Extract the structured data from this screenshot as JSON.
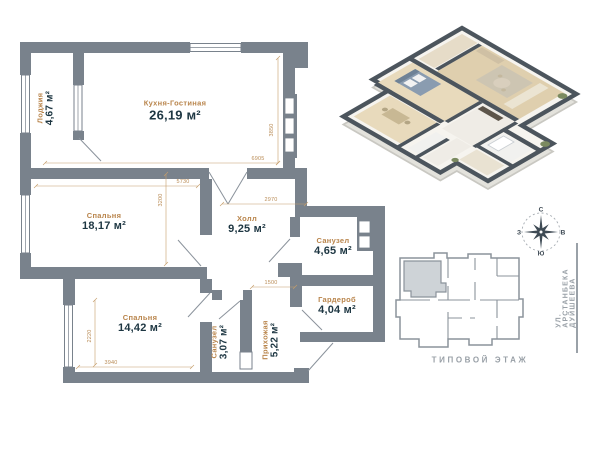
{
  "plan": {
    "rooms": [
      {
        "name": "Лоджия",
        "area": "4,67 м²"
      },
      {
        "name": "Кухня-Гостиная",
        "area": "26,19 м²"
      },
      {
        "name": "Спальня",
        "area": "18,17 м²"
      },
      {
        "name": "Холл",
        "area": "9,25 м²"
      },
      {
        "name": "Санузел",
        "area": "4,65 м²"
      },
      {
        "name": "Гардероб",
        "area": "4,04 м²"
      },
      {
        "name": "Спальня",
        "area": "14,42 м²"
      },
      {
        "name": "Санузел",
        "area": "3,07 м²"
      },
      {
        "name": "Прихожая",
        "area": "5,22 м²"
      }
    ],
    "dimensions": {
      "kitchen_width": "6905",
      "kitchen_depth": "3850",
      "bedroom1_width": "5730",
      "bedroom1_depth": "3200",
      "hall_width": "2970",
      "entry_width": "1500",
      "bedroom2_depth": "2220",
      "bedroom2_width": "3940"
    }
  },
  "compass": {
    "north": "С",
    "east": "В",
    "south": "Ю",
    "west": "З"
  },
  "floor_plan_label": "ТИПОВОЙ ЭТАЖ",
  "street_label": "УЛ. АРСТАНБЕКА ДУЙШЕЕВА",
  "colors": {
    "wall_gray": "#79828c",
    "accent_gold": "#b9854c",
    "area_text": "#1d3642",
    "muted_gray": "#99a0a7",
    "unit_highlight": "#ced3d7"
  }
}
